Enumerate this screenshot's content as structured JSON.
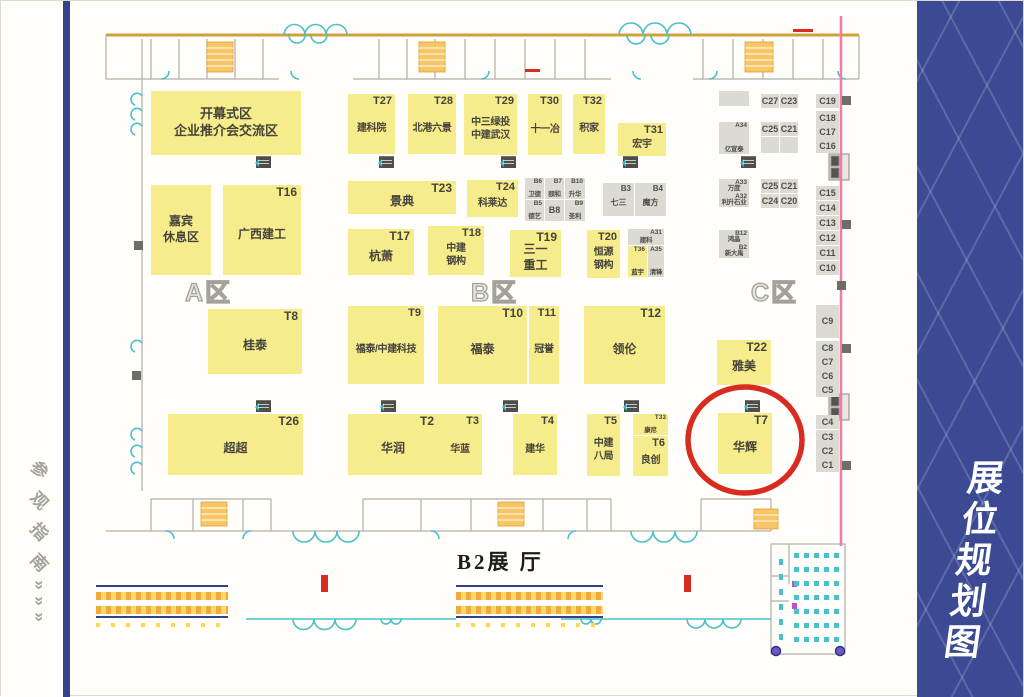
{
  "left_rail": {
    "title_chars": [
      "参",
      "观",
      "指",
      "南"
    ],
    "arrow_char": "»",
    "arrow_count": 3
  },
  "right_rail": {
    "title": "展位规划图"
  },
  "map": {
    "hall_label": "B2展 厅",
    "zones": [
      {
        "label": "A区",
        "x": 184,
        "y": 272
      },
      {
        "label": "B区",
        "x": 470,
        "y": 272
      },
      {
        "label": "C区",
        "x": 750,
        "y": 272
      }
    ],
    "booths": [
      {
        "key": "opening-area",
        "lines": [
          "开幕式区",
          "企业推介会交流区"
        ],
        "x": 150,
        "y": 90,
        "w": 150,
        "h": 64,
        "s": "lg"
      },
      {
        "key": "guest-lounge",
        "lines": [
          "嘉宾",
          "休息区"
        ],
        "x": 150,
        "y": 184,
        "w": 60,
        "h": 90
      },
      {
        "id": "T16",
        "lines": [
          "广西建工"
        ],
        "x": 222,
        "y": 184,
        "w": 78,
        "h": 90
      },
      {
        "id": "T27",
        "lines": [
          "建科院"
        ],
        "x": 347,
        "y": 93,
        "w": 47,
        "h": 60,
        "s": "sm"
      },
      {
        "id": "T28",
        "lines": [
          "北港六景"
        ],
        "x": 407,
        "y": 93,
        "w": 48,
        "h": 60,
        "s": "sm"
      },
      {
        "id": "T29",
        "lines": [
          "中三绿投",
          "中建武汉"
        ],
        "x": 463,
        "y": 93,
        "w": 53,
        "h": 61,
        "s": "sm"
      },
      {
        "id": "T30",
        "lines": [
          "十一冶"
        ],
        "x": 527,
        "y": 93,
        "w": 34,
        "h": 61,
        "s": "sm"
      },
      {
        "id": "T32",
        "lines": [
          "积家"
        ],
        "x": 572,
        "y": 93,
        "w": 32,
        "h": 60,
        "s": "sm"
      },
      {
        "id": "T31",
        "lines": [
          "宏宇"
        ],
        "x": 617,
        "y": 122,
        "w": 48,
        "h": 33,
        "s": "sm"
      },
      {
        "id": "T23",
        "lines": [
          "景典"
        ],
        "x": 347,
        "y": 180,
        "w": 108,
        "h": 33
      },
      {
        "id": "T24",
        "lines": [
          "科莱达"
        ],
        "x": 466,
        "y": 179,
        "w": 51,
        "h": 37,
        "s": "sm"
      },
      {
        "id": "T17",
        "lines": [
          "杭萧"
        ],
        "x": 347,
        "y": 228,
        "w": 66,
        "h": 46
      },
      {
        "id": "T18",
        "lines": [
          "中建",
          "钢构"
        ],
        "x": 427,
        "y": 225,
        "w": 56,
        "h": 49,
        "s": "sm"
      },
      {
        "id": "T19",
        "lines": [
          "三一",
          "重工"
        ],
        "x": 509,
        "y": 229,
        "w": 51,
        "h": 47
      },
      {
        "id": "T20",
        "lines": [
          "恒源",
          "钢构"
        ],
        "x": 586,
        "y": 229,
        "w": 33,
        "h": 48,
        "s": "sm"
      },
      {
        "id": "T36",
        "lines": [
          "蓝宇"
        ],
        "x": 627,
        "y": 245,
        "w": 19,
        "h": 31,
        "s": "xxs"
      },
      {
        "id": "T8",
        "lines": [
          "桂泰"
        ],
        "x": 207,
        "y": 308,
        "w": 94,
        "h": 65
      },
      {
        "id": "T9",
        "lines": [
          "福泰/中建科技"
        ],
        "x": 347,
        "y": 305,
        "w": 76,
        "h": 78,
        "s": "sm"
      },
      {
        "id": "T10",
        "lines": [
          "福泰"
        ],
        "x": 437,
        "y": 305,
        "w": 89,
        "h": 78
      },
      {
        "id": "T11",
        "lines": [
          "冠誉"
        ],
        "x": 528,
        "y": 305,
        "w": 30,
        "h": 78,
        "s": "sm"
      },
      {
        "id": "T12",
        "lines": [
          "领伦"
        ],
        "x": 583,
        "y": 305,
        "w": 81,
        "h": 78
      },
      {
        "id": "T22",
        "lines": [
          "雅美"
        ],
        "x": 716,
        "y": 339,
        "w": 54,
        "h": 45
      },
      {
        "id": "T26",
        "lines": [
          "超超"
        ],
        "x": 167,
        "y": 413,
        "w": 135,
        "h": 61
      },
      {
        "id": "T2",
        "lines": [
          "华润"
        ],
        "x": 347,
        "y": 413,
        "w": 90,
        "h": 61
      },
      {
        "id": "T3",
        "lines": [
          "华蓝"
        ],
        "x": 437,
        "y": 413,
        "w": 44,
        "h": 61,
        "s": "sm"
      },
      {
        "id": "T4",
        "lines": [
          "建华"
        ],
        "x": 512,
        "y": 413,
        "w": 44,
        "h": 61,
        "s": "sm"
      },
      {
        "id": "T5",
        "lines": [
          "中建",
          "八局"
        ],
        "x": 586,
        "y": 413,
        "w": 33,
        "h": 62,
        "s": "sm"
      },
      {
        "id": "T33",
        "lines": [
          "康尼"
        ],
        "x": 632,
        "y": 413,
        "w": 35,
        "h": 21,
        "s": "xxs"
      },
      {
        "id": "T6",
        "lines": [
          "良创"
        ],
        "x": 632,
        "y": 435,
        "w": 35,
        "h": 40,
        "s": "sm"
      },
      {
        "id": "T7",
        "lines": [
          "华辉"
        ],
        "x": 717,
        "y": 412,
        "w": 54,
        "h": 61,
        "hl": true
      },
      {
        "id": "B6",
        "lines": [
          "卫德"
        ],
        "x": 524,
        "y": 177,
        "w": 19,
        "h": 21,
        "t": "g",
        "s": "xxs"
      },
      {
        "id": "B7",
        "lines": [
          "颐和"
        ],
        "x": 544,
        "y": 177,
        "w": 19,
        "h": 21,
        "t": "g",
        "s": "xxs"
      },
      {
        "id": "B10",
        "lines": [
          "升华"
        ],
        "x": 564,
        "y": 177,
        "w": 20,
        "h": 21,
        "t": "g",
        "s": "xxs"
      },
      {
        "id": "B5",
        "lines": [
          "德艺"
        ],
        "x": 524,
        "y": 199,
        "w": 19,
        "h": 21,
        "t": "g",
        "s": "xxs"
      },
      {
        "id": "B8",
        "lines": [],
        "x": 544,
        "y": 199,
        "w": 19,
        "h": 21,
        "t": "g",
        "s": "cell"
      },
      {
        "id": "B9",
        "lines": [
          "圣利"
        ],
        "x": 564,
        "y": 199,
        "w": 20,
        "h": 21,
        "t": "g",
        "s": "xxs"
      },
      {
        "id": "B3",
        "lines": [
          "七三"
        ],
        "x": 602,
        "y": 182,
        "w": 31,
        "h": 33,
        "t": "g",
        "s": "xs"
      },
      {
        "id": "B4",
        "lines": [
          "魔方"
        ],
        "x": 634,
        "y": 182,
        "w": 31,
        "h": 33,
        "t": "g",
        "s": "xs"
      },
      {
        "id": "A31",
        "lines": [
          "建科"
        ],
        "x": 627,
        "y": 228,
        "w": 36,
        "h": 16,
        "t": "g",
        "s": "xxs"
      },
      {
        "id": "A35",
        "lines": [
          "清锋"
        ],
        "x": 647,
        "y": 245,
        "w": 16,
        "h": 31,
        "t": "g",
        "s": "xxs"
      },
      {
        "key": "block-1",
        "lines": [],
        "x": 718,
        "y": 90,
        "w": 30,
        "h": 15,
        "t": "g"
      },
      {
        "id": "A34",
        "lines": [
          "亿宣泰"
        ],
        "x": 718,
        "y": 121,
        "w": 30,
        "h": 32,
        "t": "g",
        "s": "xxs"
      },
      {
        "id": "C27",
        "lines": [],
        "x": 760,
        "y": 93,
        "w": 18,
        "h": 14,
        "t": "g",
        "s": "cell"
      },
      {
        "id": "C23",
        "lines": [],
        "x": 779,
        "y": 93,
        "w": 18,
        "h": 14,
        "t": "g",
        "s": "cell"
      },
      {
        "id": "C25",
        "lines": [],
        "x": 760,
        "y": 121,
        "w": 18,
        "h": 14,
        "t": "g",
        "s": "cell"
      },
      {
        "id": "C21",
        "lines": [],
        "x": 779,
        "y": 121,
        "w": 18,
        "h": 14,
        "t": "g",
        "s": "cell"
      },
      {
        "key": "block-2",
        "lines": [],
        "x": 760,
        "y": 136,
        "w": 18,
        "h": 16,
        "t": "g"
      },
      {
        "key": "block-3",
        "lines": [],
        "x": 779,
        "y": 136,
        "w": 18,
        "h": 16,
        "t": "g"
      },
      {
        "id": "A33",
        "lines": [
          "万度"
        ],
        "x": 718,
        "y": 178,
        "w": 30,
        "h": 14,
        "t": "g",
        "s": "xxs"
      },
      {
        "id": "A32",
        "lines": [
          "利升石业"
        ],
        "x": 718,
        "y": 192,
        "w": 30,
        "h": 14,
        "t": "g",
        "s": "xxs"
      },
      {
        "id": "C25",
        "lines": [],
        "x": 760,
        "y": 178,
        "w": 18,
        "h": 14,
        "t": "g",
        "s": "cell",
        "key": "C25-b"
      },
      {
        "id": "C21",
        "lines": [],
        "x": 779,
        "y": 178,
        "w": 18,
        "h": 14,
        "t": "g",
        "s": "cell",
        "key": "C21-b"
      },
      {
        "id": "C24",
        "lines": [],
        "x": 760,
        "y": 193,
        "w": 18,
        "h": 14,
        "t": "g",
        "s": "cell"
      },
      {
        "id": "C20",
        "lines": [],
        "x": 779,
        "y": 193,
        "w": 18,
        "h": 14,
        "t": "g",
        "s": "cell"
      },
      {
        "id": "B12",
        "lines": [
          "鸿晶"
        ],
        "x": 718,
        "y": 229,
        "w": 30,
        "h": 14,
        "t": "g",
        "s": "xxs"
      },
      {
        "id": "B2",
        "lines": [
          "新大禹"
        ],
        "x": 718,
        "y": 243,
        "w": 30,
        "h": 14,
        "t": "g",
        "s": "xxs"
      },
      {
        "id": "C19",
        "lines": [],
        "x": 815,
        "y": 93,
        "w": 23,
        "h": 14,
        "t": "g",
        "s": "cell"
      },
      {
        "id": "C18",
        "lines": [],
        "x": 815,
        "y": 110,
        "w": 23,
        "h": 14,
        "t": "g",
        "s": "cell"
      },
      {
        "id": "C17",
        "lines": [],
        "x": 815,
        "y": 124,
        "w": 23,
        "h": 14,
        "t": "g",
        "s": "cell"
      },
      {
        "id": "C16",
        "lines": [],
        "x": 815,
        "y": 138,
        "w": 23,
        "h": 14,
        "t": "g",
        "s": "cell"
      },
      {
        "id": "C15",
        "lines": [],
        "x": 815,
        "y": 185,
        "w": 23,
        "h": 14,
        "t": "g",
        "s": "cell"
      },
      {
        "id": "C14",
        "lines": [],
        "x": 815,
        "y": 200,
        "w": 23,
        "h": 14,
        "t": "g",
        "s": "cell"
      },
      {
        "id": "C13",
        "lines": [],
        "x": 815,
        "y": 215,
        "w": 23,
        "h": 14,
        "t": "g",
        "s": "cell"
      },
      {
        "id": "C12",
        "lines": [],
        "x": 815,
        "y": 230,
        "w": 23,
        "h": 14,
        "t": "g",
        "s": "cell"
      },
      {
        "id": "C11",
        "lines": [],
        "x": 815,
        "y": 245,
        "w": 23,
        "h": 14,
        "t": "g",
        "s": "cell"
      },
      {
        "id": "C10",
        "lines": [],
        "x": 815,
        "y": 260,
        "w": 23,
        "h": 14,
        "t": "g",
        "s": "cell"
      },
      {
        "id": "C9",
        "lines": [],
        "x": 815,
        "y": 304,
        "w": 23,
        "h": 33,
        "t": "g",
        "s": "cell"
      },
      {
        "id": "C8",
        "lines": [],
        "x": 815,
        "y": 340,
        "w": 23,
        "h": 14,
        "t": "g",
        "s": "cell"
      },
      {
        "id": "C7",
        "lines": [],
        "x": 815,
        "y": 354,
        "w": 23,
        "h": 14,
        "t": "g",
        "s": "cell"
      },
      {
        "id": "C6",
        "lines": [],
        "x": 815,
        "y": 368,
        "w": 23,
        "h": 14,
        "t": "g",
        "s": "cell"
      },
      {
        "id": "C5",
        "lines": [],
        "x": 815,
        "y": 382,
        "w": 23,
        "h": 14,
        "t": "g",
        "s": "cell"
      },
      {
        "id": "C4",
        "lines": [],
        "x": 815,
        "y": 414,
        "w": 23,
        "h": 14,
        "t": "g",
        "s": "cell"
      },
      {
        "id": "C3",
        "lines": [],
        "x": 815,
        "y": 429,
        "w": 23,
        "h": 14,
        "t": "g",
        "s": "cell"
      },
      {
        "id": "C2",
        "lines": [],
        "x": 815,
        "y": 443,
        "w": 23,
        "h": 14,
        "t": "g",
        "s": "cell"
      },
      {
        "id": "C1",
        "lines": [],
        "x": 815,
        "y": 457,
        "w": 23,
        "h": 14,
        "t": "g",
        "s": "cell"
      }
    ],
    "doors": [
      [
        255,
        155
      ],
      [
        378,
        155
      ],
      [
        500,
        155
      ],
      [
        622,
        155
      ],
      [
        740,
        155
      ],
      [
        255,
        399
      ],
      [
        380,
        399
      ],
      [
        502,
        399
      ],
      [
        623,
        399
      ],
      [
        744,
        399
      ]
    ],
    "wall_marks": [
      [
        841,
        95
      ],
      [
        841,
        219
      ],
      [
        836,
        280
      ],
      [
        841,
        343
      ],
      [
        841,
        460
      ],
      [
        133,
        240
      ],
      [
        131,
        370
      ]
    ],
    "red_bars": [
      [
        320,
        574
      ],
      [
        683,
        574
      ]
    ],
    "walkways": [
      {
        "x": 95,
        "y": 584,
        "w": 132
      },
      {
        "x": 455,
        "y": 584,
        "w": 147
      }
    ],
    "highlight": {
      "booth": "T7",
      "cx": 744,
      "cy": 439,
      "rx": 57,
      "ry": 53,
      "color": "#d92c21",
      "stroke_width": 5.5
    }
  }
}
